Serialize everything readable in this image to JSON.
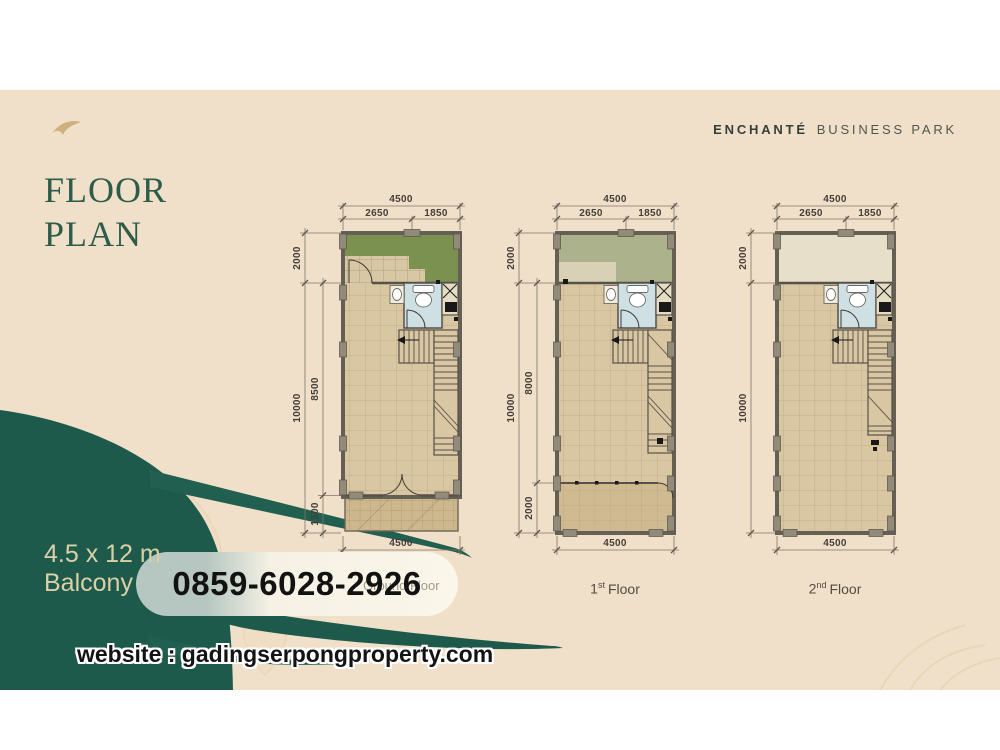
{
  "brand": {
    "name_primary": "ENCHANTÉ",
    "name_secondary": "BUSINESS PARK"
  },
  "page_title": {
    "line1": "FLOOR",
    "line2": "PLAN"
  },
  "unit_info": {
    "dimensions": "4.5 x 12 m",
    "feature": "Balcony"
  },
  "contact": {
    "phone": "0859-6028-2926",
    "website": "website : gadingserpongproperty.com"
  },
  "plans": [
    {
      "label": {
        "full": "Ground Floor"
      },
      "dims": {
        "width_total": "4500",
        "width_left": "2650",
        "width_right": "1850",
        "front_zone": "2000",
        "inner_main": "8500",
        "side_total": "10000",
        "rear_zone": "1500",
        "width_bottom": "4500"
      }
    },
    {
      "label": {
        "num": "1",
        "sup": "st",
        "word": "Floor"
      },
      "dims": {
        "width_total": "4500",
        "width_left": "2650",
        "width_right": "1850",
        "front_zone": "2000",
        "inner_main": "8000",
        "side_total": "10000",
        "rear_zone": "2000",
        "width_bottom": "4500"
      }
    },
    {
      "label": {
        "num": "2",
        "sup": "nd",
        "word": "Floor"
      },
      "dims": {
        "width_total": "4500",
        "width_left": "2650",
        "width_right": "1850",
        "front_zone": "2000",
        "side_total": "10000",
        "width_bottom": "4500"
      }
    }
  ],
  "colors": {
    "background": "#f1e0c9",
    "brand_green": "#1d5a4b",
    "title_green": "#2d5c4a",
    "floor_tan": "#d9c6a2",
    "garden_green": "#7b9150",
    "sage_green": "#abb28c",
    "void_beige": "#e7dfca",
    "bathroom_blue": "#cfe0e4",
    "cream_text": "#dbd0a8",
    "phone_text": "#121212"
  }
}
